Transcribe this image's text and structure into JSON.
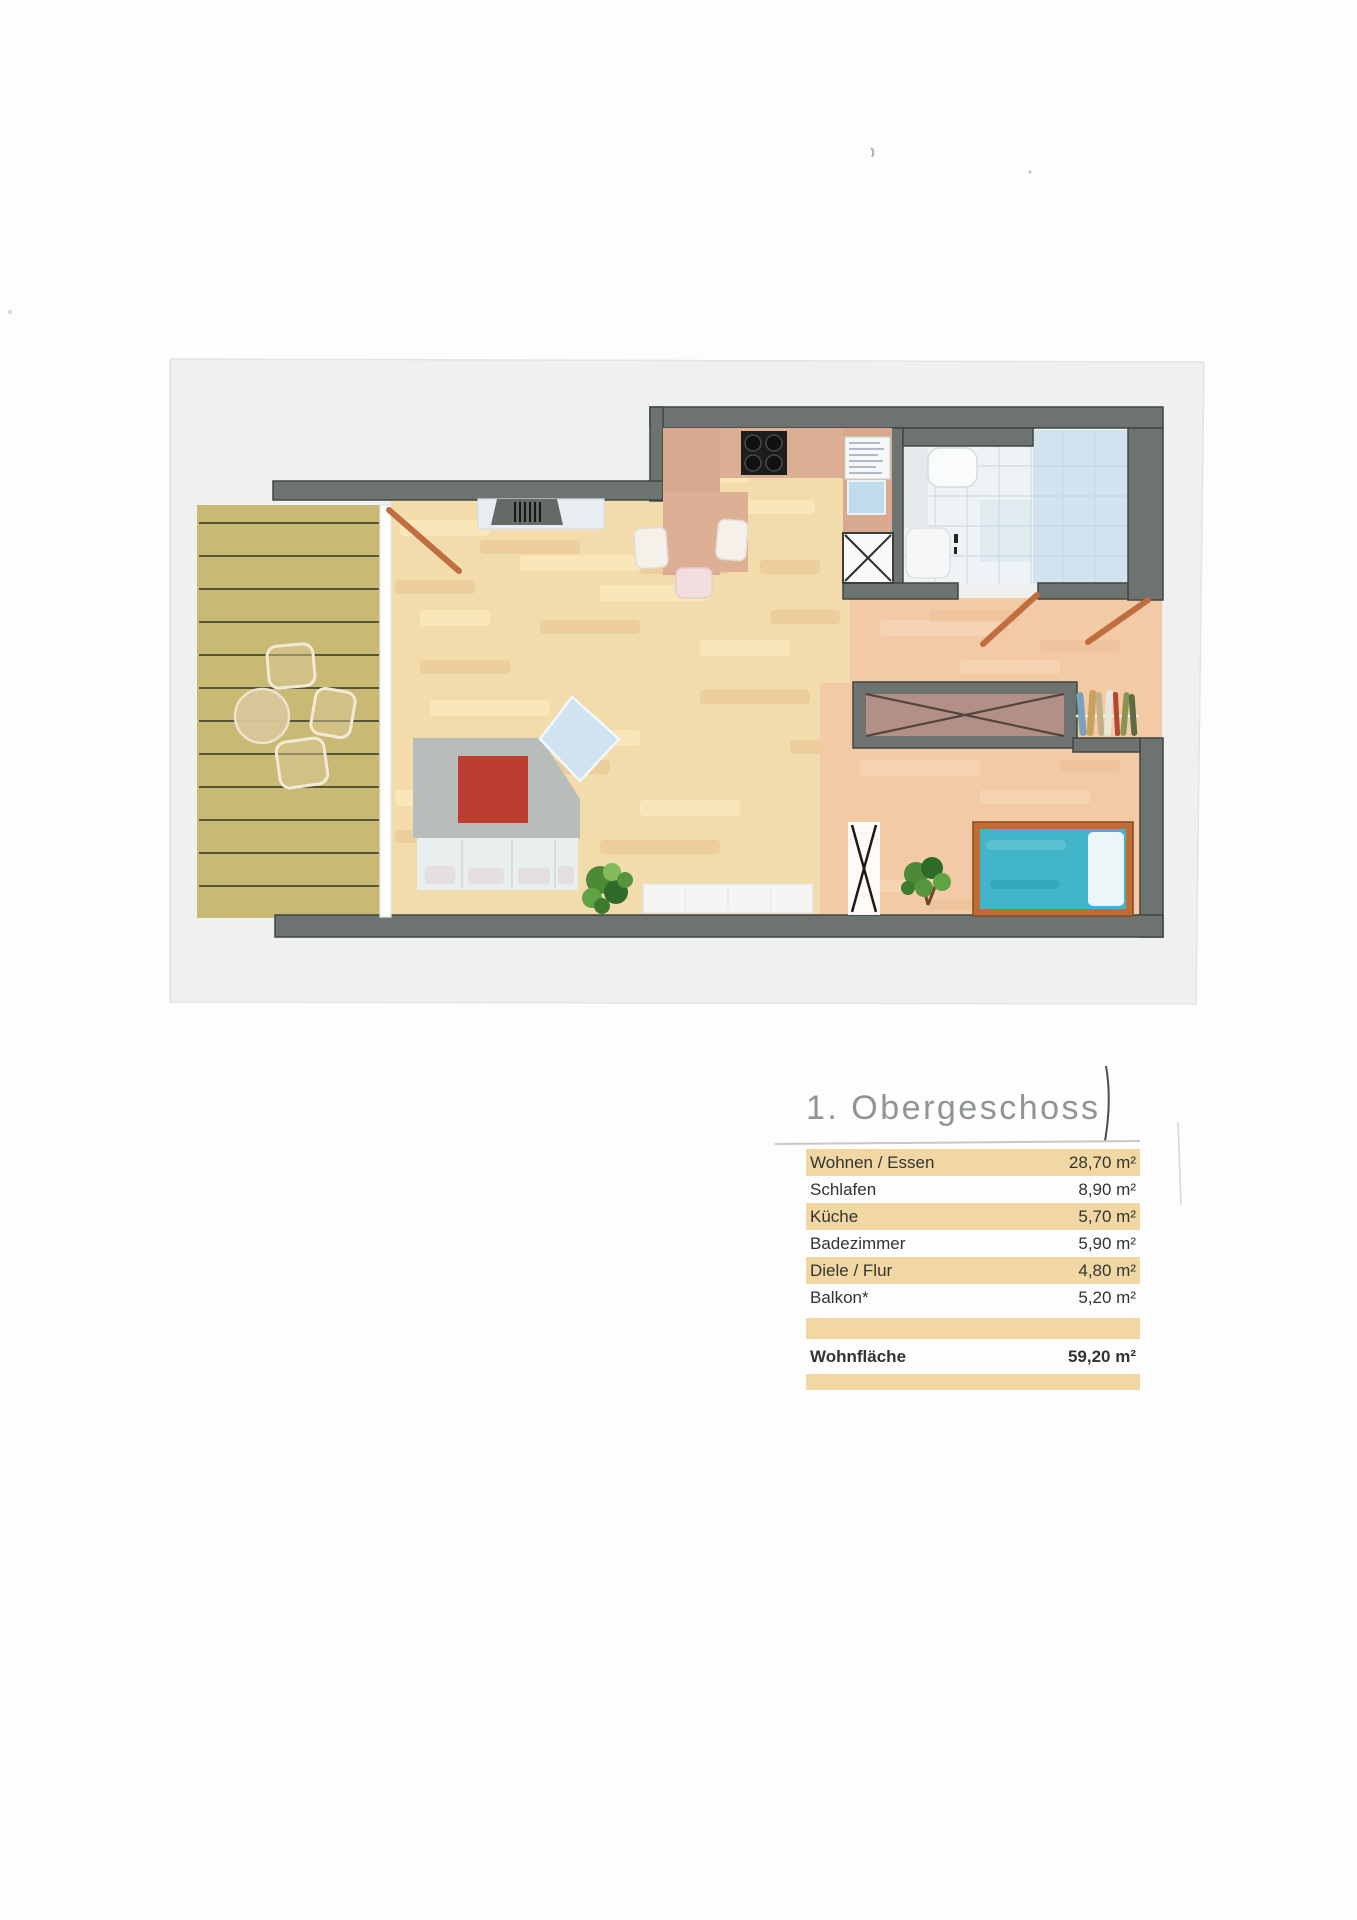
{
  "legend": {
    "title": "1. Obergeschoss",
    "rows": [
      {
        "label": "Wohnen / Essen",
        "value": "28,70 m²",
        "highlight": true
      },
      {
        "label": "Schlafen",
        "value": "8,90 m²",
        "highlight": false
      },
      {
        "label": "Küche",
        "value": "5,70 m²",
        "highlight": true
      },
      {
        "label": "Badezimmer",
        "value": "5,90 m²",
        "highlight": false
      },
      {
        "label": "Diele / Flur",
        "value": "4,80 m²",
        "highlight": true
      },
      {
        "label": "Balkon*",
        "value": "5,20 m²",
        "highlight": false
      }
    ],
    "total": {
      "label": "Wohnfläche",
      "value": "59,20 m²"
    }
  },
  "colors": {
    "row_highlight": "#f1d7a4",
    "title_gray": "#8f9591",
    "text": "#333432",
    "wall": "#6c7370",
    "parquet_floor": "#f3dcab",
    "tile_floor_salmon": "#f2cba6",
    "balcony_deck": "#c8b975",
    "bathroom_tile": "#eef3f5",
    "bathroom_blue": "#bcd6e9",
    "kitchen_counter": "#dcae93",
    "bed_frame": "#bf6c35",
    "bed_mattress": "#42b5c9",
    "sofa_gray": "#b8bcbb",
    "sofa_cushion_red": "#bf3c30",
    "door_swing": "#c06e3f"
  }
}
